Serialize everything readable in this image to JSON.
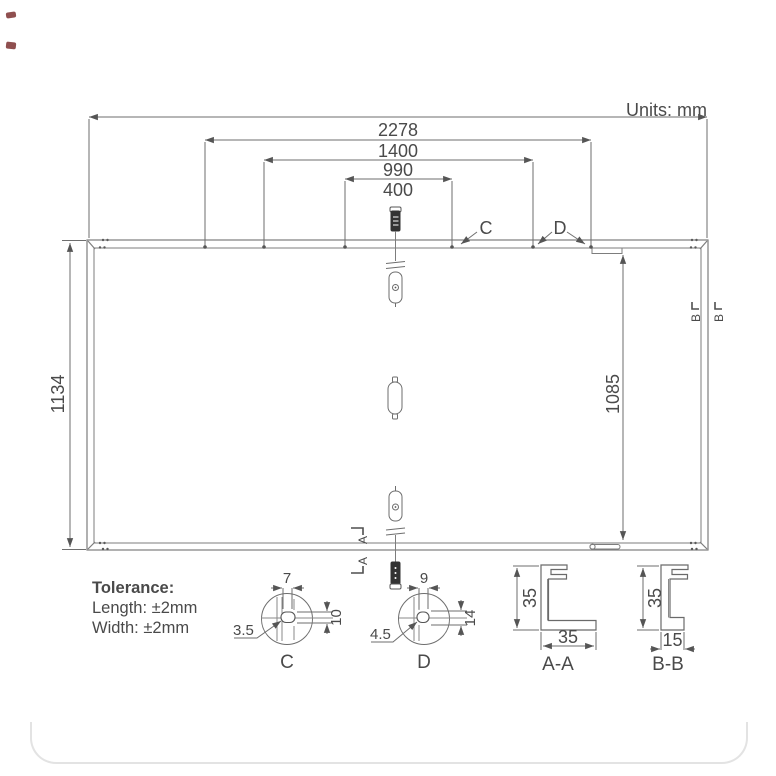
{
  "drawing": {
    "units_label": "Units: mm",
    "dims": {
      "top": [
        "2278",
        "1400",
        "990",
        "400"
      ],
      "height_left": "1134",
      "height_right": "1085"
    },
    "callouts": {
      "c": "C",
      "d": "D"
    },
    "tolerance": {
      "title": "Tolerance:",
      "length": "Length:  ±2mm",
      "width": "Width:  ±2mm"
    },
    "detail_c": {
      "width": "7",
      "height": "10",
      "radius": "3.5",
      "label": "C"
    },
    "detail_d": {
      "width": "9",
      "height": "14",
      "radius": "4.5",
      "label": "D"
    },
    "section_aa": {
      "height": "35",
      "width": "35",
      "label": "A-A",
      "marker": "A"
    },
    "section_bb": {
      "height": "35",
      "width": "15",
      "label": "B-B",
      "marker": "B"
    },
    "colors": {
      "frame_line": "#7d7d7d",
      "dim_line": "#6e6e6e",
      "text": "#4a4a4a",
      "dark_part": "#333333",
      "accent_mark": "#7b3030",
      "card_border": "#e3e3e3"
    }
  }
}
